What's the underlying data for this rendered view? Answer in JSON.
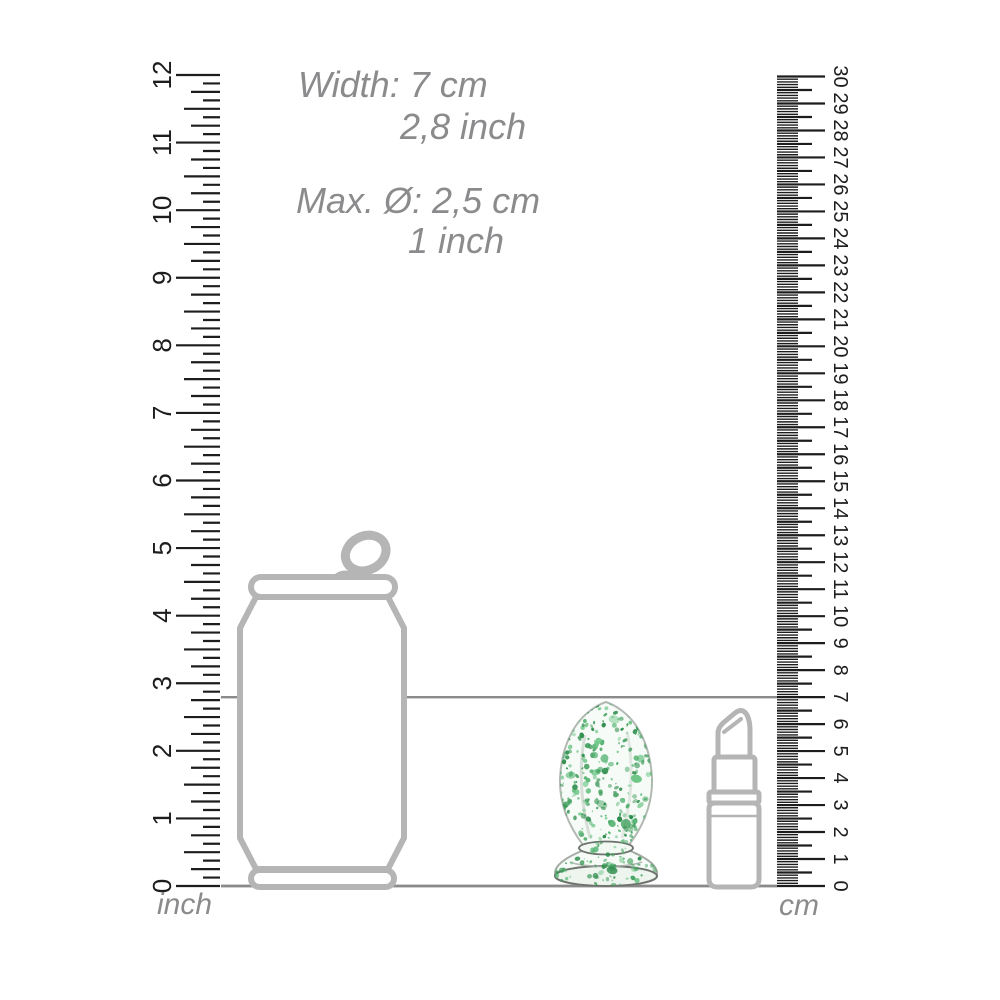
{
  "annotations": {
    "width_cm": "Width: 7 cm",
    "width_inch": "2,8 inch",
    "diameter_cm": "Max. Ø: 2,5 cm",
    "diameter_inch": "1 inch"
  },
  "rulers": {
    "inch": {
      "unit_label": "inch",
      "min": 0,
      "max": 12,
      "numbers": [
        0,
        1,
        2,
        3,
        4,
        5,
        6,
        7,
        8,
        9,
        10,
        11,
        12
      ],
      "subdivisions_per_unit": 8
    },
    "cm": {
      "unit_label": "cm",
      "min": 0,
      "max": 30,
      "numbers": [
        0,
        1,
        2,
        3,
        4,
        5,
        6,
        7,
        8,
        9,
        10,
        11,
        12,
        13,
        14,
        15,
        16,
        17,
        18,
        19,
        20,
        21,
        22,
        23,
        24,
        25,
        26,
        27,
        28,
        29,
        30
      ],
      "subdivisions_per_unit": 10
    }
  },
  "reference": {
    "product_height_cm": 7,
    "product_height_inch": 2.8
  },
  "objects": [
    {
      "name": "soda-can"
    },
    {
      "name": "glass-plug-green-speckled"
    },
    {
      "name": "lipstick"
    }
  ],
  "colors": {
    "background": "#ffffff",
    "tick": "#1d1d1d",
    "number": "#1d1d1d",
    "annotation_text": "#8b8b8d",
    "outline_gray": "#b5b5b5",
    "reference_line": "#8a8a8a",
    "glass_fill": "#f7fbf7",
    "glass_edge": "#b2b9b3",
    "speckle_greens": [
      "#3e9e5b",
      "#57b474",
      "#2c8c4b",
      "#6cc586"
    ]
  }
}
